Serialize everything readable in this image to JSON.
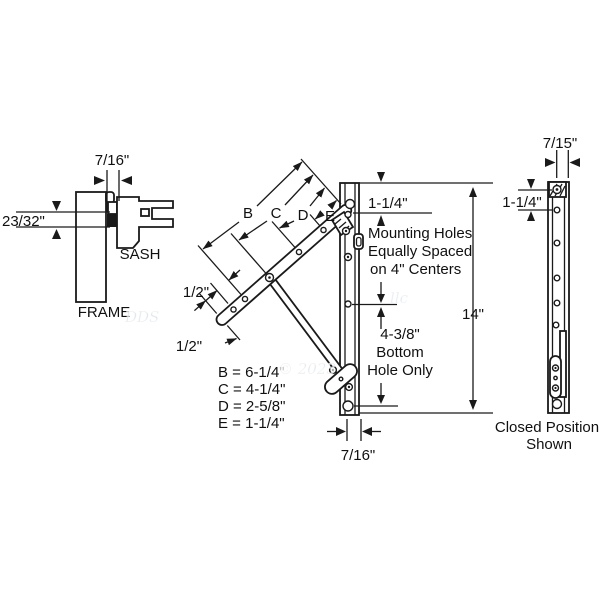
{
  "cross_section": {
    "gap_dim": "7/16\"",
    "thickness_dim": "23/32\"",
    "sash_label": "SASH",
    "frame_label": "FRAME"
  },
  "arm_dims": {
    "b_label": "B",
    "c_label": "C",
    "d_label": "D",
    "e_label": "E",
    "half_upper": "1/2\"",
    "half_lower": "1/2\"",
    "legend": [
      "B = 6-1/4\"",
      "C = 4-1/4\"",
      "D = 2-5/8\"",
      "E = 1-1/4\""
    ]
  },
  "track": {
    "top_offset": "1-1/4\"",
    "mounting_note_1": "Mounting Holes",
    "mounting_note_2": "Equally Spaced",
    "mounting_note_3": "on 4\" Centers",
    "length": "14\"",
    "bottom_spacing": "4-3/8\"",
    "bottom_note_1": "Bottom",
    "bottom_note_2": "Hole Only",
    "width": "7/16\""
  },
  "closed_track": {
    "width": "7/15\"",
    "top_offset": "1-1/4\"",
    "caption_1": "Closed Position",
    "caption_2": "Shown"
  },
  "watermark": {
    "part1": "DDS",
    "part2": "llc",
    "year": "© 2023"
  },
  "colors": {
    "line": "#1a1a1a",
    "watermark": "#a8bdcb",
    "background": "#ffffff"
  }
}
